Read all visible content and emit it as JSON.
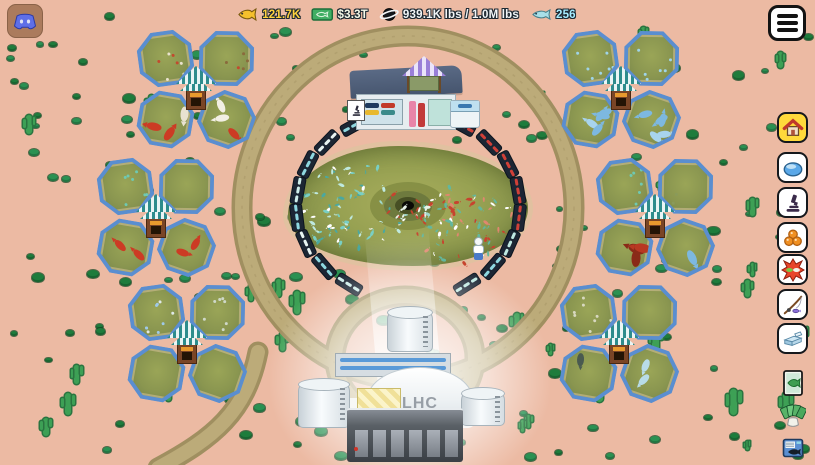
{
  "hud": {
    "stats": [
      {
        "id": "coins",
        "icon": "gold-fish-icon",
        "value": "121.7K",
        "color": "#ffd23d"
      },
      {
        "id": "cash",
        "icon": "cash-icon",
        "value": "$3.3T",
        "color": "#f5f9e8"
      },
      {
        "id": "weight",
        "icon": "planet-icon",
        "value": "939.1K lbs / 1.0M lbs",
        "color": "#f2f5f7"
      },
      {
        "id": "fish",
        "icon": "blue-fish-icon",
        "value": "256",
        "color": "#a5ecff"
      }
    ]
  },
  "collider": {
    "label": "LHC"
  },
  "sidebar": {
    "items": [
      {
        "id": "home",
        "icon": "home-icon",
        "bg": "#ffd93b",
        "boxed": true
      },
      {
        "id": "ponds",
        "icon": "pond-dome-icon",
        "bg": "#ffffff",
        "boxed": true
      },
      {
        "id": "research",
        "icon": "microscope-icon",
        "bg": "#ffffff",
        "boxed": true
      },
      {
        "id": "roe",
        "icon": "fish-eggs-icon",
        "bg": "#ffffff",
        "boxed": true
      },
      {
        "id": "battle",
        "icon": "fish-fight-icon",
        "bg": "#ffffff",
        "boxed": true
      },
      {
        "id": "fishing",
        "icon": "fishing-rod-icon",
        "bg": "#ffffff",
        "boxed": true
      },
      {
        "id": "tickets",
        "icon": "tickets-icon",
        "bg": "#ffffff",
        "boxed": true
      },
      {
        "id": "fish-card",
        "icon": "fish-card-icon",
        "bg": "",
        "boxed": false
      },
      {
        "id": "card-hand",
        "icon": "card-hand-icon",
        "bg": "",
        "boxed": false
      },
      {
        "id": "fish-index",
        "icon": "fish-index-icon",
        "bg": "",
        "boxed": false
      }
    ]
  },
  "scene": {
    "background": "#ecbaa3",
    "track_color": "#bcab79",
    "pond_water": "#97a152",
    "cluster_border": "#5a8ed0",
    "clusters": [
      {
        "id": "top-left",
        "x": 137,
        "y": 30,
        "ponds": [
          {
            "kind": "spots",
            "count": 7,
            "colors": [
              "#e9e2cc",
              "#c24a2e"
            ]
          },
          {
            "kind": "spots",
            "count": 5,
            "colors": [
              "#8a6a3c",
              "#c24a2e"
            ]
          },
          {
            "kind": "fish",
            "count": 3,
            "size": 15,
            "colors": [
              "#cc3b24",
              "#e8e2d0"
            ]
          },
          {
            "kind": "fish",
            "count": 3,
            "size": 14,
            "colors": [
              "#cc3b24",
              "#f2efe4"
            ]
          }
        ]
      },
      {
        "id": "mid-left",
        "x": 97,
        "y": 158,
        "ponds": [
          {
            "kind": "spots",
            "count": 7,
            "colors": [
              "#6fc9b2"
            ]
          },
          {
            "kind": "none",
            "count": 0,
            "colors": []
          },
          {
            "kind": "fish",
            "count": 2,
            "size": 14,
            "colors": [
              "#cc3b24"
            ]
          },
          {
            "kind": "fish",
            "count": 2,
            "size": 13,
            "colors": [
              "#cc3b24"
            ]
          }
        ]
      },
      {
        "id": "bottom-left",
        "x": 128,
        "y": 284,
        "ponds": [
          {
            "kind": "spots",
            "count": 9,
            "colors": [
              "#dfe8e8",
              "#9fc9e8"
            ]
          },
          {
            "kind": "spots",
            "count": 7,
            "colors": [
              "#cfd8c8"
            ]
          },
          {
            "kind": "none",
            "count": 0,
            "colors": []
          },
          {
            "kind": "none",
            "count": 0,
            "colors": []
          }
        ]
      },
      {
        "id": "top-right",
        "x": 562,
        "y": 30,
        "ponds": [
          {
            "kind": "spots",
            "count": 7,
            "colors": [
              "#9fd4e8"
            ]
          },
          {
            "kind": "spots",
            "count": 6,
            "colors": [
              "#9fd4e8"
            ]
          },
          {
            "kind": "fish",
            "count": 5,
            "size": 14,
            "colors": [
              "#7db8e0",
              "#a8d4ee"
            ]
          },
          {
            "kind": "fish",
            "count": 5,
            "size": 14,
            "colors": [
              "#7db8e0",
              "#a8d4ee"
            ]
          }
        ]
      },
      {
        "id": "mid-right",
        "x": 596,
        "y": 158,
        "ponds": [
          {
            "kind": "spots",
            "count": 6,
            "colors": [
              "#6fc9b2"
            ]
          },
          {
            "kind": "spots",
            "count": 2,
            "colors": [
              "#8a9a5a"
            ]
          },
          {
            "kind": "fish",
            "count": 3,
            "size": 17,
            "colors": [
              "#b83822",
              "#8a2a18"
            ]
          },
          {
            "kind": "fish",
            "count": 1,
            "size": 16,
            "colors": [
              "#7db8e0"
            ]
          }
        ]
      },
      {
        "id": "bottom-right",
        "x": 560,
        "y": 284,
        "ponds": [
          {
            "kind": "spots",
            "count": 8,
            "colors": [
              "#d8d8c0"
            ]
          },
          {
            "kind": "none",
            "count": 0,
            "colors": []
          },
          {
            "kind": "fish",
            "count": 1,
            "size": 13,
            "colors": [
              "#4a5a50"
            ]
          },
          {
            "kind": "fish",
            "count": 2,
            "size": 13,
            "colors": [
              "#b8dce8"
            ]
          }
        ]
      }
    ],
    "docks": {
      "cx": 408,
      "cy": 206,
      "rx": 112,
      "ry": 92,
      "list": [
        {
          "angle": 122,
          "fish": "#cfeeea"
        },
        {
          "angle": 139,
          "fish": "#8fd8e0"
        },
        {
          "angle": 156,
          "fish": "#e8f4f2"
        },
        {
          "angle": 173,
          "fish": "#8fd8e0"
        },
        {
          "angle": 190,
          "fish": "#cfeeea"
        },
        {
          "angle": 207,
          "fish": "#8fd8e0"
        },
        {
          "angle": 224,
          "fish": "#e8f4f2"
        },
        {
          "angle": 241,
          "fish": "#8fd8e0"
        },
        {
          "angle": 58,
          "fish": "#bfe9e2"
        },
        {
          "angle": 41,
          "fish": "#8fd8e0"
        },
        {
          "angle": 24,
          "fish": "#bfe9e2"
        },
        {
          "angle": 7,
          "fish": "#d04038"
        },
        {
          "angle": -10,
          "fish": "#d04038"
        },
        {
          "angle": -27,
          "fish": "#d04038"
        },
        {
          "angle": -44,
          "fish": "#d04038"
        },
        {
          "angle": -61,
          "fish": "#d04038"
        }
      ]
    },
    "fish_swarms": [
      {
        "x": 352,
        "y": 206,
        "rx": 56,
        "ry": 44,
        "count": 75,
        "colors": [
          "#bfe9df",
          "#ffffff",
          "#79cfc4",
          "#4aa8a0"
        ]
      },
      {
        "x": 464,
        "y": 224,
        "rx": 52,
        "ry": 40,
        "count": 75,
        "colors": [
          "#c7432e",
          "#ffffff",
          "#63b79e",
          "#e0876f"
        ]
      },
      {
        "x": 408,
        "y": 204,
        "rx": 32,
        "ry": 14,
        "count": 22,
        "colors": [
          "#9fd8cc",
          "#c7432e",
          "#e8f2e8"
        ]
      }
    ],
    "decor": {
      "bushes": 155,
      "cacti": 46,
      "seed": 987654321
    }
  }
}
